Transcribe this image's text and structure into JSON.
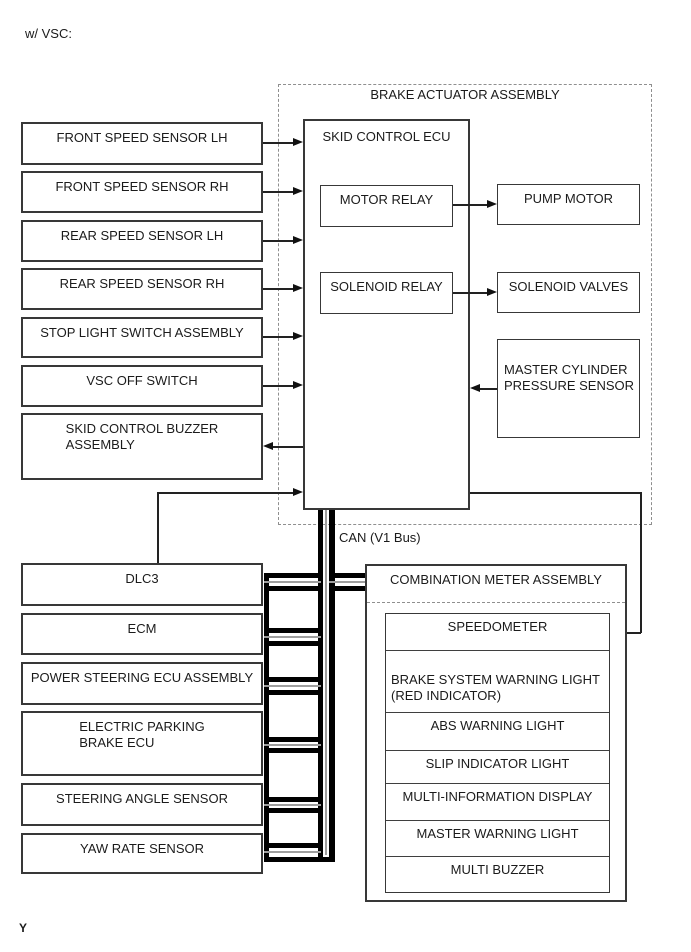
{
  "page": {
    "variant_label": "w/ VSC:",
    "page_marker": "Y"
  },
  "bus": {
    "label": "CAN (V1 Bus)",
    "wire_color": "#000000",
    "pair_center_color": "#9e9e9e"
  },
  "brake_actuator": {
    "title": "BRAKE ACTUATOR ASSEMBLY",
    "skid_control_ecu": {
      "label": "SKID CONTROL ECU"
    },
    "motor_relay": {
      "label": "MOTOR RELAY"
    },
    "solenoid_relay": {
      "label": "SOLENOID RELAY"
    },
    "pump_motor": {
      "label": "PUMP MOTOR"
    },
    "solenoid_valves": {
      "label": "SOLENOID VALVES"
    },
    "master_cylinder_pressure_sensor": {
      "label": "MASTER CYLINDER\nPRESSURE SENSOR"
    }
  },
  "input_devices": [
    {
      "label": "FRONT SPEED SENSOR LH"
    },
    {
      "label": "FRONT SPEED SENSOR RH"
    },
    {
      "label": "REAR SPEED SENSOR LH"
    },
    {
      "label": "REAR SPEED SENSOR RH"
    },
    {
      "label": "STOP LIGHT SWITCH ASSEMBLY"
    },
    {
      "label": "VSC OFF SWITCH"
    },
    {
      "label": "SKID CONTROL BUZZER\nASSEMBLY"
    }
  ],
  "can_nodes": [
    {
      "label": "DLC3"
    },
    {
      "label": "ECM"
    },
    {
      "label": "POWER STEERING ECU ASSEMBLY"
    },
    {
      "label": "ELECTRIC PARKING\nBRAKE ECU"
    },
    {
      "label": "STEERING ANGLE SENSOR"
    },
    {
      "label": "YAW RATE SENSOR"
    }
  ],
  "combination_meter": {
    "title": "COMBINATION METER ASSEMBLY",
    "items": [
      {
        "label": "SPEEDOMETER"
      },
      {
        "label": "BRAKE SYSTEM WARNING LIGHT\n(RED INDICATOR)"
      },
      {
        "label": "ABS WARNING LIGHT"
      },
      {
        "label": "SLIP INDICATOR LIGHT"
      },
      {
        "label": "MULTI-INFORMATION DISPLAY"
      },
      {
        "label": "MASTER WARNING LIGHT"
      },
      {
        "label": "MULTI BUZZER"
      }
    ]
  }
}
